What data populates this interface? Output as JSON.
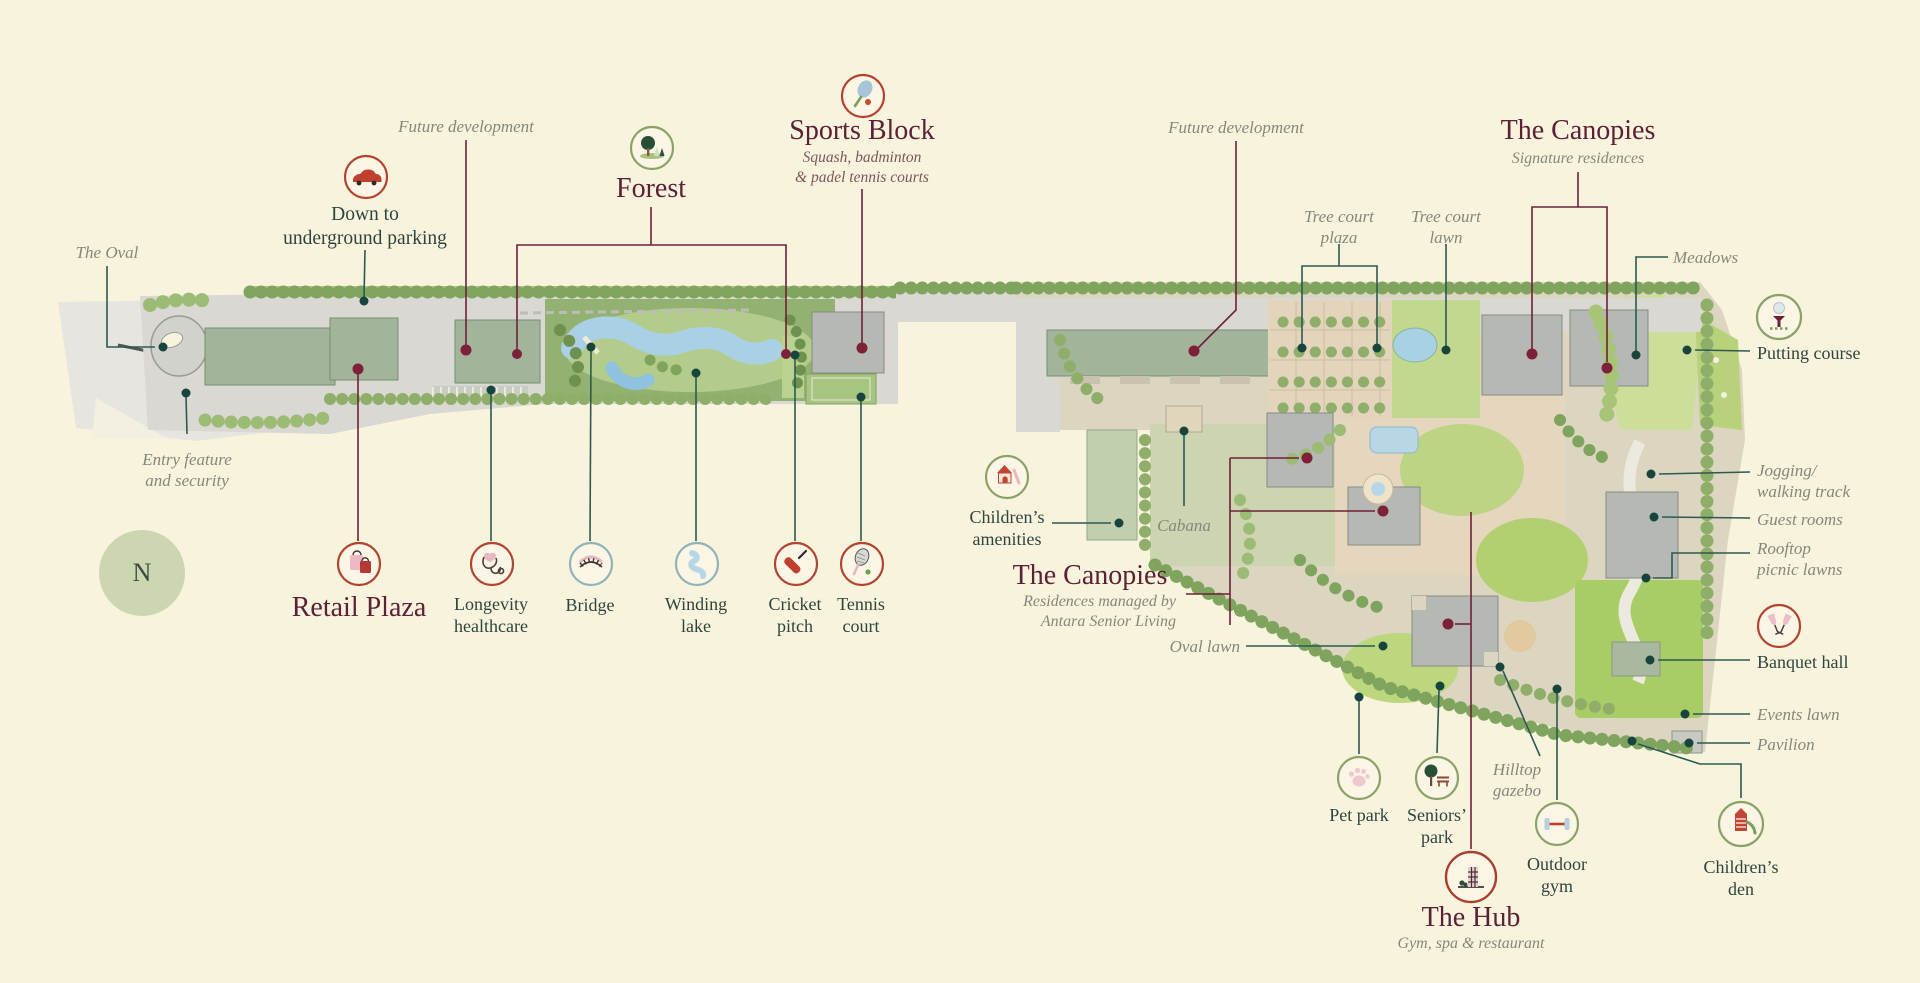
{
  "colors": {
    "background": "#f8f3dd",
    "title_maroon": "#5b2136",
    "label_dark": "#2d453d",
    "label_italic_gray": "#84887b",
    "callout_teal": "#2c5a50",
    "callout_maroon": "#6e2136",
    "icon_ring_red": "#b2432f",
    "icon_ring_green": "#8aa268",
    "icon_ring_blue": "#8fb3b8",
    "compass_fill": "#ccd7b2"
  },
  "compass": {
    "label": "N"
  },
  "icons": {
    "parking": "car-icon",
    "forest": "tree-icon",
    "sports_block": "tennis-racket-icon",
    "retail_plaza": "shopping-bags-icon",
    "longevity": "stethoscope-heart-icon",
    "bridge": "bridge-icon",
    "winding_lake": "river-icon",
    "cricket_pitch": "cricket-bat-icon",
    "tennis_court": "racket-ball-icon",
    "childrens_amenities": "playhouse-icon",
    "putting_course": "golf-tee-icon",
    "banquet_hall": "champagne-glasses-icon",
    "pet_park": "paw-icon",
    "seniors_park": "tree-bench-icon",
    "outdoor_gym": "dumbbell-icon",
    "childrens_den": "play-tower-icon",
    "the_hub": "building-icon"
  },
  "labels": {
    "the_oval": {
      "text": "The Oval"
    },
    "future_dev_left": {
      "text": "Future development"
    },
    "parking": {
      "line1": "Down to",
      "line2": "underground parking"
    },
    "forest": {
      "title": "Forest"
    },
    "sports_block": {
      "title": "Sports Block",
      "sub1": "Squash, badminton",
      "sub2": "& padel tennis courts"
    },
    "entry": {
      "line1": "Entry feature",
      "line2": "and security"
    },
    "retail_plaza": {
      "title": "Retail Plaza"
    },
    "longevity": {
      "line1": "Longevity",
      "line2": "healthcare"
    },
    "bridge": {
      "text": "Bridge"
    },
    "winding_lake": {
      "line1": "Winding",
      "line2": "lake"
    },
    "cricket_pitch": {
      "line1": "Cricket",
      "line2": "pitch"
    },
    "tennis_court": {
      "line1": "Tennis",
      "line2": "court"
    },
    "childrens_amenities": {
      "line1": "Children’s",
      "line2": "amenities"
    },
    "cabana": {
      "text": "Cabana"
    },
    "canopies_managed": {
      "title": "The Canopies",
      "sub1": "Residences managed by",
      "sub2": "Antara Senior Living"
    },
    "oval_lawn": {
      "text": "Oval lawn"
    },
    "future_dev_right": {
      "text": "Future development"
    },
    "tree_court_plaza": {
      "line1": "Tree court",
      "line2": "plaza"
    },
    "tree_court_lawn": {
      "line1": "Tree court",
      "line2": "lawn"
    },
    "canopies_signature": {
      "title": "The Canopies",
      "sub": "Signature residences"
    },
    "meadows": {
      "text": "Meadows"
    },
    "putting_course": {
      "text": "Putting course"
    },
    "jogging": {
      "line1": "Jogging/",
      "line2": "walking track"
    },
    "guest_rooms": {
      "text": "Guest rooms"
    },
    "rooftop": {
      "line1": "Rooftop",
      "line2": "picnic lawns"
    },
    "banquet_hall": {
      "text": "Banquet hall"
    },
    "events_lawn": {
      "text": "Events lawn"
    },
    "pavilion": {
      "text": "Pavilion"
    },
    "childrens_den": {
      "line1": "Children’s",
      "line2": "den"
    },
    "pet_park": {
      "text": "Pet park"
    },
    "seniors_park": {
      "line1": "Seniors’",
      "line2": "park"
    },
    "hilltop_gazebo": {
      "line1": "Hilltop",
      "line2": "gazebo"
    },
    "outdoor_gym": {
      "line1": "Outdoor",
      "line2": "gym"
    },
    "the_hub": {
      "title": "The Hub",
      "sub": "Gym, spa & restaurant"
    }
  }
}
